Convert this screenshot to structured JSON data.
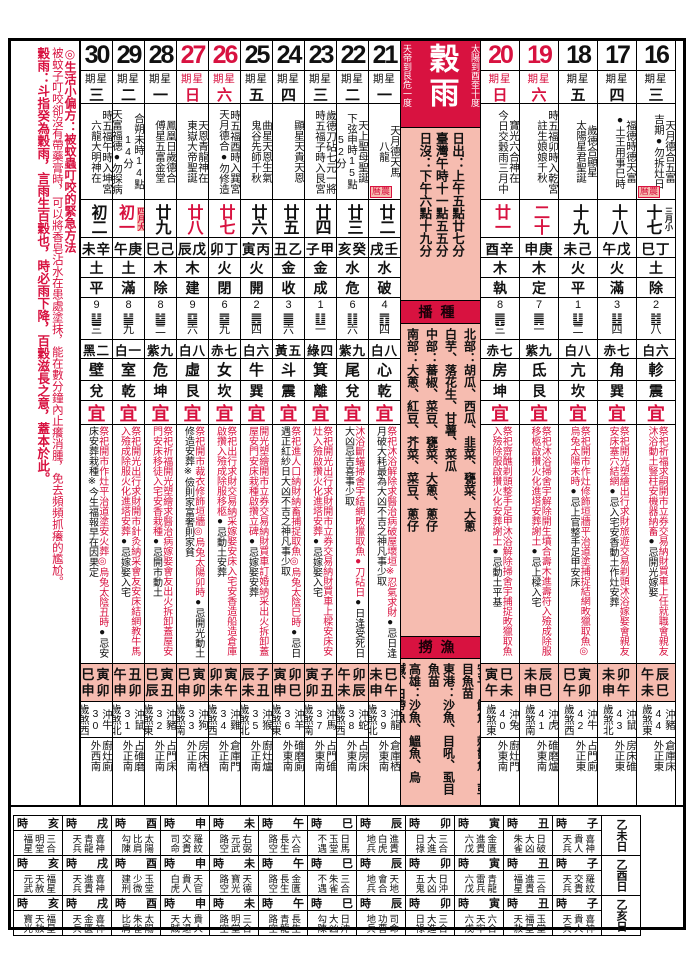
{
  "left_margin": {
    "tip_title": "◎生活小偏方：被蚊蟲叮咬的緊急方法",
    "tip_body": "被蚊子叮咬卻沒有帶藥膏時，可以將香皂沾水在患處塗抹，能在數分鐘內止癢消腫，免去頻頻抓癢的尷尬。",
    "term_note": "穀雨：斗指癸為穀雨，言雨生百穀也，時必雨下降，百穀滋長之意，蓋本於此。"
  },
  "center": {
    "term_name": "穀雨",
    "right_note": "天帝到艮危一度",
    "left_note": "太陽到酉奎十度",
    "sun_lines": [
      "日出：上午五點廿七分",
      "臺灣午時十一點五五分",
      "日沒：下午六點十九分"
    ],
    "sowing_header": "播種",
    "sowing_lines": [
      "北部：胡瓜、西瓜、韭菜、甕菜、大蔥",
      "白芋、落花生、甘薯、菜瓜",
      "中部：蕃椒、菜豆、甕菜、大蔥、蔥仔",
      "南部：大蔥、紅豆、芥菜、菜豆、蔥仔"
    ],
    "fishing_header": "撈漁",
    "fishing_lines": [
      "安平：鮸魚、棘鬣魚、虱目魚苗",
      "東港：沙魚、目吼、虱目魚苗",
      "高雄：沙魚、鰮魚、烏鰔、白帶魚"
    ]
  },
  "labels": {
    "weekday_prefix": "期星",
    "yi": "宜",
    "lunar_tag": "曆農",
    "shi": "時"
  },
  "colors": {
    "accent_red": "#d81240",
    "pink": "#f6bcb0"
  },
  "days": [
    {
      "date": "30",
      "red": false,
      "weekday": "三",
      "deities": [
        "時五福午時入坤宮",
        "六龍大明神在"
      ],
      "lunar": "初二",
      "lunar_red": false,
      "lunar_note": "",
      "ganzhi": "未辛",
      "wuxing": "土",
      "jianchu": "平",
      "gua_num": "9",
      "gua_hex": "䷊",
      "gua_cn": "三",
      "jiuxing": "黑二",
      "xiu": "壁",
      "bagua": "兌",
      "yi_red": "祭祀開市作灶平治道塗安火葬◎烏兔太陰丑時",
      "yi_black": "●忌安床安葬栽種※今生福報早在因果定",
      "jishi": [
        "巳寅",
        "申卯"
      ],
      "chong": "沖牛30",
      "sha": "歲煞西",
      "tai_place": "廚灶廁",
      "tai_dir": "外西南",
      "tag": false
    },
    {
      "date": "29",
      "red": false,
      "weekday": "二",
      "deities": [
        "合朔未時14點14分",
        "天富福德●勿探病"
      ],
      "lunar": "初一",
      "lunar_red": true,
      "lunar_note": "四月大",
      "lunar_note_red": true,
      "ganzhi": "午庚",
      "wuxing": "土",
      "jianchu": "滿",
      "gua_num": "8",
      "gua_hex": "䷡",
      "gua_cn": "九",
      "jiuxing": "白一",
      "xiu": "室",
      "bagua": "乾",
      "yi_red": "祭祀開光出行求財開市針灸納采會友安床結網教牛馬入殮成除服火化進塔安葬",
      "yi_black": "●忌嫁娶入宅",
      "jishi": [
        "午丑",
        "申卯"
      ],
      "chong": "沖鼠31",
      "sha": "歲煞北",
      "tai_place": "占碓磨",
      "tai_dir": "外正南",
      "tag": false
    },
    {
      "date": "28",
      "red": false,
      "weekday": "一",
      "deities": [
        "鳳凰日歲德合",
        "傅星五富金堂"
      ],
      "lunar": "廿九",
      "lunar_red": false,
      "lunar_note": "",
      "ganzhi": "巳己",
      "wuxing": "木",
      "jianchu": "除",
      "gua_num": "8",
      "gua_hex": "䷄",
      "gua_cn": "二",
      "jiuxing": "紫九",
      "xiu": "危",
      "bagua": "坤",
      "yi_red": "祭祀祈福開光塑繪求醫治病嫁娶會友出火拆卸蓋屋安門安床移徒入宅安香栽種",
      "yi_black": "●忌開市動土",
      "jishi": [
        "巳寅",
        "辰丑"
      ],
      "chong": "沖豬32",
      "sha": "歲煞東",
      "tai_place": "占門床",
      "tai_dir": "外正南",
      "tag": false
    },
    {
      "date": "27",
      "red": true,
      "weekday": "日",
      "deities": [
        "天恩青龍神在",
        "東嶽大帝聖誕"
      ],
      "lunar": "廿八",
      "lunar_red": true,
      "lunar_note": "",
      "ganzhi": "辰戊",
      "wuxing": "木",
      "jianchu": "建",
      "gua_num": "9",
      "gua_hex": "䷙",
      "gua_cn": "六",
      "jiuxing": "白八",
      "xiu": "虛",
      "bagua": "艮",
      "yi_red": "祭祀開市裁衣修飾垣牆◎烏兔太陽卯時",
      "yi_black": "●忌開光動土修造安葬※儉則家富奢則家貧",
      "jishi": [
        "巳寅",
        "申卯"
      ],
      "chong": "沖狗33",
      "sha": "歲煞南",
      "tai_place": "房床栖",
      "tai_dir": "外正南",
      "tag": false
    },
    {
      "date": "26",
      "red": true,
      "weekday": "六",
      "deities": [
        "時五福酉時入巽宮",
        "天月德合●勿修造"
      ],
      "lunar": "廿七",
      "lunar_red": true,
      "lunar_note": "",
      "ganzhi": "卯丁",
      "wuxing": "火",
      "jianchu": "閉",
      "gua_num": "6",
      "gua_hex": "䷈",
      "gua_cn": "九",
      "jiuxing": "赤七",
      "xiu": "女",
      "bagua": "坎",
      "yi_red": "祭祀出行求財交易納采嫁娶安床入宅安香造船造倉庫啟攢入殮成除服移柩",
      "yi_black": "●忌動土安葬",
      "jishi": [
        "卯寅",
        "未午"
      ],
      "chong": "沖雞34",
      "sha": "歲煞西",
      "tai_place": "倉庫門",
      "tai_dir": "外正南",
      "tag": false
    },
    {
      "date": "25",
      "red": false,
      "weekday": "五",
      "deities": [
        "曲星天恩生氣",
        "鬼谷先師千秋"
      ],
      "lunar": "廿六",
      "lunar_red": false,
      "lunar_note": "",
      "ganzhi": "寅丙",
      "wuxing": "火",
      "jianchu": "開",
      "gua_num": "2",
      "gua_hex": "䷌",
      "gua_cn": "四",
      "jiuxing": "白六",
      "xiu": "牛",
      "bagua": "巽",
      "yi_red": "開光塑繪開市立券交易納財買車訂婚納采出火拆卸蓋屋安門安床栽種啟攢立碑",
      "yi_black": "●忌嫁娶安葬",
      "jishi": [
        "辰子",
        "未丑"
      ],
      "chong": "沖猴35",
      "sha": "歲煞北",
      "tai_place": "廚灶爐",
      "tai_dir": "外正南",
      "tag": false
    },
    {
      "date": "24",
      "red": false,
      "weekday": "四",
      "deities": [
        "顯星天貴天恩"
      ],
      "lunar": "廿五",
      "lunar_red": false,
      "lunar_note": "",
      "ganzhi": "丑乙",
      "wuxing": "金",
      "jianchu": "收",
      "gua_num": "3",
      "gua_hex": "䷀",
      "gua_cn": "六",
      "jiuxing": "黃五",
      "xiu": "斗",
      "bagua": "震",
      "yi_red": "祭祀進人口納財納畜捕捉取魚◎烏兔太陰巳時",
      "yi_black": "●忌日遇正紅紗日大凶不吉之神凡事少取",
      "jishi": [
        "寅卯",
        "申巳"
      ],
      "chong": "沖羊36",
      "sha": "歲煞東",
      "tai_place": "碓磨廁",
      "tai_dir": "外東南",
      "tag": false
    },
    {
      "date": "23",
      "red": false,
      "weekday": "三",
      "deities": [
        "歲德刀砧七元一將",
        "時五福子時入艮宮"
      ],
      "lunar": "廿四",
      "lunar_red": false,
      "lunar_note": "",
      "ganzhi": "子甲",
      "wuxing": "金",
      "jianchu": "成",
      "gua_num": "1",
      "gua_hex": "䷗",
      "gua_cn": "一",
      "jiuxing": "綠四",
      "xiu": "箕",
      "bagua": "離",
      "yi_red": "祭祀開光出行求財開市立券交易納財買車上樑安床安灶入殮啟攢火化進塔安葬",
      "yi_black": "●忌嫁娶入宅",
      "jishi": [
        "寅子",
        "卯丑"
      ],
      "chong": "沖馬37",
      "sha": "歲煞南",
      "tai_place": "占門碓",
      "tai_dir": "外東南",
      "tag": false
    },
    {
      "date": "22",
      "red": false,
      "weekday": "二",
      "deities": [
        "天上聖母聖誕",
        "下弦申時15點52分"
      ],
      "lunar": "廿三",
      "lunar_red": false,
      "lunar_note": "",
      "ganzhi": "亥癸",
      "wuxing": "水",
      "jianchu": "危",
      "gua_num": "6",
      "gua_hex": "䷁",
      "gua_cn": "六",
      "jiuxing": "紫九",
      "xiu": "尾",
      "bagua": "兌",
      "yi_red": "沐浴斷蟻掃舍宇結網畋獵取魚●刀砧日",
      "yi_black": "●日逢受死日大凶忌吉喜事少取",
      "jishi": [
        "午卯",
        "未辰"
      ],
      "chong": "沖蛇38",
      "sha": "歲煞西",
      "tai_place": "占房床",
      "tai_dir": "外東南",
      "tag": false
    },
    {
      "date": "21",
      "red": false,
      "weekday": "一",
      "deities": [
        "天月德天馬",
        "八龍"
      ],
      "lunar": "廿二",
      "lunar_red": false,
      "lunar_note": "",
      "ganzhi": "戌壬",
      "wuxing": "水",
      "jianchu": "破",
      "gua_num": "4",
      "gua_hex": "䷓",
      "gua_cn": "四",
      "jiuxing": "白八",
      "xiu": "心",
      "bagua": "乾",
      "yi_red": "祭祀沐浴解除求醫治病破屋壞垣※忍氣求財",
      "yi_black": "●忌日逢月破大耗最為大凶不吉之神凡事少取",
      "jishi": [
        "未巳",
        "申午"
      ],
      "chong": "沖龍39",
      "sha": "歲煞北",
      "tai_place": "倉庫栖",
      "tai_dir": "外東南",
      "tag": true
    },
    {
      "date": "20",
      "red": true,
      "weekday": "日",
      "deities": [
        "寶光六合神在",
        "今日交穀雨三月中"
      ],
      "lunar": "廿一",
      "lunar_red": true,
      "lunar_note": "",
      "ganzhi": "酉辛",
      "wuxing": "木",
      "jianchu": "執",
      "gua_num": "8",
      "gua_hex": "䷠",
      "gua_cn": "三",
      "jiuxing": "赤七",
      "xiu": "房",
      "bagua": "坤",
      "yi_red": "祭祀齋醮剃頭整手足甲沐浴解除掃舍宇捕捉畋獵取魚入殮除服啟攢火化安葬謝土",
      "yi_black": "●忌動土平基",
      "jishi": [
        "寅巳",
        "午未"
      ],
      "chong": "沖兔40",
      "sha": "歲煞東",
      "tai_place": "廚灶門",
      "tai_dir": "外東南",
      "tag": false
    },
    {
      "date": "19",
      "red": true,
      "weekday": "六",
      "deities": [
        "時五福卯時入乾宮",
        "註生娘娘千秋"
      ],
      "lunar": "二十",
      "lunar_red": true,
      "lunar_note": "",
      "ganzhi": "申庚",
      "wuxing": "木",
      "jianchu": "定",
      "gua_num": "7",
      "gua_hex": "䷫",
      "gua_cn": "一",
      "jiuxing": "紫九",
      "xiu": "氐",
      "bagua": "艮",
      "yi_red": "祭祀沐浴掃舍宇解除開生墳合壽木進壽符入殮成除服移柩啟攢火化進塔安葬謝土",
      "yi_black": "●忌上樑入宅",
      "jishi": [
        "未辰",
        "申巳"
      ],
      "chong": "沖虎41",
      "sha": "歲煞南",
      "tai_place": "碓磨爐",
      "tai_dir": "外東南",
      "tag": false
    },
    {
      "date": "18",
      "red": false,
      "weekday": "五",
      "deities": [
        "歲德合顯星",
        "太陽星君聖誕"
      ],
      "lunar": "十九",
      "lunar_red": false,
      "lunar_note": "",
      "ganzhi": "未己",
      "wuxing": "火",
      "jianchu": "平",
      "gua_num": "1",
      "gua_hex": "䷒",
      "gua_cn": "二",
      "jiuxing": "白八",
      "xiu": "亢",
      "bagua": "坎",
      "yi_red": "祭祀開市作灶修飾垣牆平治道塗捕捉結網畋獵取魚◎烏兔太陽未時",
      "yi_black": "●忌上官整手足甲安床",
      "jishi": [
        "巳寅",
        "午卯"
      ],
      "chong": "沖牛42",
      "sha": "歲煞西",
      "tai_place": "占門廁",
      "tai_dir": "外正東",
      "tag": false
    },
    {
      "date": "17",
      "red": false,
      "weekday": "四",
      "deities": [
        "福德時德天富",
        "●土王用事巳時"
      ],
      "lunar": "十八",
      "lunar_red": false,
      "lunar_note": "",
      "ganzhi": "午戊",
      "wuxing": "火",
      "jianchu": "滿",
      "gua_num": "3",
      "gua_hex": "䷣",
      "gua_cn": "四",
      "jiuxing": "赤七",
      "xiu": "角",
      "bagua": "巽",
      "yi_red": "祭祀開光塑繪出行求財旅遊交易剃頭沐浴嫁娶會親友安床塞穴結網",
      "yi_black": "●忌入宅安香動土作灶安葬",
      "jishi": [
        "未卯",
        "申午"
      ],
      "chong": "沖鼠43",
      "sha": "歲煞北",
      "tai_place": "房床碓",
      "tai_dir": "外正東",
      "tag": false
    },
    {
      "date": "16",
      "red": false,
      "weekday": "三",
      "deities": [
        "天月德合五富",
        "吉期●勿拆灶日"
      ],
      "lunar": "十七",
      "lunar_red": false,
      "lunar_note": "三月小",
      "lunar_note_red": false,
      "ganzhi": "巳丁",
      "wuxing": "土",
      "jianchu": "除",
      "gua_num": "2",
      "gua_hex": "䷾",
      "gua_cn": "八",
      "jiuxing": "白六",
      "xiu": "軫",
      "bagua": "震",
      "yi_red": "祭祀祈福求嗣開市立券交易納財買車上任就職會親友沐浴動土豎柱安機器納畜",
      "yi_black": "●忌開光嫁娶",
      "jishi": [
        "午辰",
        "未巳"
      ],
      "chong": "沖豬44",
      "sha": "歲煞東",
      "tai_place": "倉庫床",
      "tai_dir": "外正東",
      "tag": true
    }
  ],
  "hour_table": {
    "hours": [
      "亥",
      "戌",
      "酉",
      "申",
      "未",
      "午",
      "巳",
      "辰",
      "卯",
      "寅",
      "丑",
      "子"
    ],
    "rows": [
      {
        "label": "乙未日",
        "cells": [
          [
            "福星",
            "明堂",
            "三合"
          ],
          [
            "天兵",
            "青龍",
            "喜神"
          ],
          [
            "勾陳",
            "比肩",
            "太陽"
          ],
          [
            "司命",
            "交貴",
            "羅紋"
          ],
          [
            "路空",
            "元武",
            "右弼"
          ],
          [
            "路空",
            "長生",
            "六合"
          ],
          [
            "不遇",
            "玉堂",
            "日馬"
          ],
          [
            "地兵",
            "白虎",
            "進貴"
          ],
          [
            "日祿",
            "大進",
            "三合"
          ],
          [
            "六戊",
            "進貴",
            "金匱"
          ],
          [
            "朱雀",
            "大凶",
            "日破"
          ],
          [
            "天兵",
            "貴人",
            "喜神"
          ]
        ]
      },
      {
        "label": "乙酉日",
        "cells": [
          [
            "元武",
            "天赦",
            "福星"
          ],
          [
            "天兵",
            "進貴",
            "喜神"
          ],
          [
            "建刑",
            "少微",
            "玉堂"
          ],
          [
            "白虎",
            "貴人",
            "天官"
          ],
          [
            "路空",
            "寶光",
            "天德"
          ],
          [
            "路空",
            "長生",
            "金匱"
          ],
          [
            "不遇",
            "朱雀",
            "三合"
          ],
          [
            "地兵",
            "會合",
            "天地"
          ],
          [
            "五鬼",
            "大凶",
            "日沖"
          ],
          [
            "六戊",
            "雷兵",
            "青龍"
          ],
          [
            "福星",
            "進貴",
            "三合"
          ],
          [
            "天兵",
            "交貴",
            "羅紋"
          ]
        ]
      },
      {
        "label": "乙亥日",
        "cells": [
          [
            "寶光",
            "天赦",
            "福星"
          ],
          [
            "天兵",
            "金匱",
            "喜神"
          ],
          [
            "比肩",
            "朱雀",
            "太陽"
          ],
          [
            "天賊",
            "大退",
            "貴人"
          ],
          [
            "路空",
            "明堂",
            "三合"
          ],
          [
            "路空",
            "青龍",
            "長生"
          ],
          [
            "勾陳",
            "大凶",
            "日沖"
          ],
          [
            "地兵",
            "功曹",
            "司命"
          ],
          [
            "日祿",
            "大進",
            "三合"
          ],
          [
            "六戊",
            "天牢",
            "六合"
          ],
          [
            "天赦",
            "福星",
            "玉堂"
          ],
          [
            "天兵",
            "貴人",
            "喜神"
          ]
        ]
      }
    ]
  }
}
